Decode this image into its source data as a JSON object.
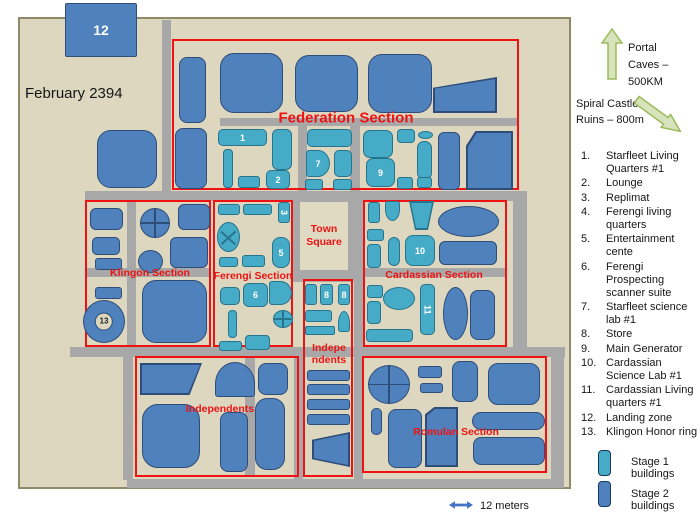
{
  "header": {
    "date": "February 2394"
  },
  "landmarks": {
    "portal": "Portal Caves – 500KM",
    "spiral": "Spiral Castle Ruins – 800m"
  },
  "key": {
    "items": [
      {
        "num": "1.",
        "label": "Starfleet Living Quarters #1"
      },
      {
        "num": "2.",
        "label": "Lounge"
      },
      {
        "num": "3.",
        "label": "Replimat"
      },
      {
        "num": "4.",
        "label": "Ferengi living quarters"
      },
      {
        "num": "5.",
        "label": "Entertainment cente"
      },
      {
        "num": "6.",
        "label": "Ferengi Prospecting scanner suite"
      },
      {
        "num": "7.",
        "label": "Starfleet science lab #1"
      },
      {
        "num": "8.",
        "label": "Store"
      },
      {
        "num": "9.",
        "label": "Main Generator"
      },
      {
        "num": "10.",
        "label": "Cardassian Science Lab #1"
      },
      {
        "num": "11.",
        "label": "Cardassian Living quarters #1"
      },
      {
        "num": "12.",
        "label": "Landing zone"
      },
      {
        "num": "13.",
        "label": "Klingon Honor ring"
      }
    ]
  },
  "legend": {
    "stage1": "Stage 1 buildings",
    "stage2": "Stage 2 buildings"
  },
  "scale": {
    "label": "12 meters"
  },
  "colors": {
    "map_bg": "#ddd7c0",
    "map_border": "#8f8968",
    "road": "#a8a8a8",
    "red": "#ee1212",
    "stage1_fill": "#46abc7",
    "stage1_border": "#26748e",
    "stage2_fill": "#4f81bd",
    "stage2_border": "#2e4d79",
    "square_bg": "#e0dac3",
    "arrow_fill": "#d6e3bc",
    "arrow_border": "#9bbb59",
    "scale_blue": "#4472c4",
    "text": "#161616"
  },
  "map": {
    "town_square": {
      "label": "Town Square",
      "x": 300,
      "y": 202,
      "w": 48,
      "h": 68
    },
    "sections": [
      {
        "id": "federation",
        "name": "Federation Section",
        "x": 172,
        "y": 39,
        "w": 347,
        "h": 151,
        "lx": 346,
        "ly": 118,
        "fs": 15
      },
      {
        "id": "klingon",
        "name": "Klingon Section",
        "x": 85,
        "y": 200,
        "w": 126,
        "h": 147,
        "lx": 150,
        "ly": 273,
        "fs": 10.5
      },
      {
        "id": "ferengi",
        "name": "Ferengi Section",
        "x": 213,
        "y": 200,
        "w": 80,
        "h": 147,
        "lx": 253,
        "ly": 276,
        "fs": 10.5
      },
      {
        "id": "cardassian",
        "name": "Cardassian Section",
        "x": 363,
        "y": 200,
        "w": 144,
        "h": 147,
        "lx": 434,
        "ly": 275,
        "fs": 10.5
      },
      {
        "id": "independents-mid",
        "name": "Indepe\nndents",
        "x": 303,
        "y": 279,
        "w": 50,
        "h": 198,
        "lx": 329,
        "ly": 354,
        "fs": 10.5
      },
      {
        "id": "independents",
        "name": "Independents",
        "x": 135,
        "y": 356,
        "w": 164,
        "h": 121,
        "lx": 220,
        "ly": 409,
        "fs": 10.5
      },
      {
        "id": "romulan",
        "name": "Romulan Section",
        "x": 362,
        "y": 356,
        "w": 185,
        "h": 117,
        "lx": 456,
        "ly": 432,
        "fs": 10.5
      }
    ],
    "roads": [
      [
        162,
        20,
        9,
        171
      ],
      [
        85,
        191,
        442,
        10
      ],
      [
        220,
        118,
        298,
        8
      ],
      [
        298,
        126,
        9,
        65
      ],
      [
        350,
        126,
        10,
        65
      ],
      [
        127,
        200,
        9,
        147
      ],
      [
        85,
        268,
        126,
        9
      ],
      [
        293,
        191,
        70,
        91
      ],
      [
        363,
        268,
        144,
        9
      ],
      [
        513,
        191,
        14,
        166
      ],
      [
        70,
        347,
        495,
        10
      ],
      [
        123,
        357,
        10,
        123
      ],
      [
        245,
        357,
        10,
        120
      ],
      [
        294,
        357,
        9,
        123
      ],
      [
        354,
        270,
        9,
        210
      ],
      [
        551,
        357,
        13,
        122
      ],
      [
        127,
        479,
        437,
        9
      ]
    ],
    "buildings": [
      {
        "x": 65,
        "y": 3,
        "w": 72,
        "h": 54,
        "s": 2,
        "sh": "r2",
        "lb": "12",
        "ls": 14
      },
      {
        "x": 97,
        "y": 130,
        "w": 60,
        "h": 58,
        "s": 2,
        "sh": "r14"
      },
      {
        "x": 179,
        "y": 57,
        "w": 27,
        "h": 66,
        "s": 2,
        "sh": "r8"
      },
      {
        "x": 220,
        "y": 53,
        "w": 63,
        "h": 60,
        "s": 2,
        "sh": "r14"
      },
      {
        "x": 295,
        "y": 55,
        "w": 63,
        "h": 57,
        "s": 2,
        "sh": "r14"
      },
      {
        "x": 368,
        "y": 54,
        "w": 64,
        "h": 59,
        "s": 2,
        "sh": "r14"
      },
      {
        "x": 433,
        "y": 77,
        "w": 64,
        "h": 36,
        "s": 2,
        "sh": "poly:0% 30%,100% 0%,100% 100%,0% 100%"
      },
      {
        "x": 175,
        "y": 128,
        "w": 32,
        "h": 61,
        "s": 2,
        "sh": "r8"
      },
      {
        "x": 218,
        "y": 129,
        "w": 49,
        "h": 17,
        "s": 1,
        "sh": "r5",
        "lb": "1"
      },
      {
        "x": 272,
        "y": 129,
        "w": 20,
        "h": 41,
        "s": 1,
        "sh": "r6"
      },
      {
        "x": 223,
        "y": 149,
        "w": 10,
        "h": 39,
        "s": 1,
        "sh": "r4"
      },
      {
        "x": 238,
        "y": 176,
        "w": 22,
        "h": 12,
        "s": 1,
        "sh": "r3"
      },
      {
        "x": 266,
        "y": 170,
        "w": 24,
        "h": 19,
        "s": 1,
        "sh": "r5",
        "lb": "2"
      },
      {
        "x": 307,
        "y": 129,
        "w": 45,
        "h": 18,
        "s": 1,
        "sh": "r5"
      },
      {
        "x": 306,
        "y": 150,
        "w": 24,
        "h": 27,
        "s": 1,
        "sh": "d-right",
        "lb": "7"
      },
      {
        "x": 334,
        "y": 150,
        "w": 18,
        "h": 27,
        "s": 1,
        "sh": "r5"
      },
      {
        "x": 305,
        "y": 179,
        "w": 18,
        "h": 11,
        "s": 1,
        "sh": "r3"
      },
      {
        "x": 333,
        "y": 179,
        "w": 19,
        "h": 11,
        "s": 1,
        "sh": "r3"
      },
      {
        "x": 363,
        "y": 130,
        "w": 30,
        "h": 28,
        "s": 1,
        "sh": "r7"
      },
      {
        "x": 366,
        "y": 158,
        "w": 29,
        "h": 29,
        "s": 1,
        "sh": "r7",
        "lb": "9"
      },
      {
        "x": 397,
        "y": 129,
        "w": 18,
        "h": 14,
        "s": 1,
        "sh": "r4"
      },
      {
        "x": 418,
        "y": 131,
        "w": 15,
        "h": 8,
        "s": 1,
        "sh": "ellipse"
      },
      {
        "x": 417,
        "y": 141,
        "w": 15,
        "h": 39,
        "s": 1,
        "sh": "r7"
      },
      {
        "x": 397,
        "y": 177,
        "w": 16,
        "h": 12,
        "s": 1,
        "sh": "r3"
      },
      {
        "x": 417,
        "y": 177,
        "w": 15,
        "h": 11,
        "s": 1,
        "sh": "r3"
      },
      {
        "x": 438,
        "y": 132,
        "w": 22,
        "h": 58,
        "s": 2,
        "sh": "r6"
      },
      {
        "x": 466,
        "y": 131,
        "w": 47,
        "h": 59,
        "s": 2,
        "sh": "poly:0% 25%,20% 0%,100% 0%,100% 100%,0% 100%"
      },
      {
        "x": 90,
        "y": 208,
        "w": 33,
        "h": 22,
        "s": 2,
        "sh": "r6"
      },
      {
        "x": 92,
        "y": 237,
        "w": 28,
        "h": 18,
        "s": 2,
        "sh": "r5"
      },
      {
        "x": 95,
        "y": 258,
        "w": 27,
        "h": 12,
        "s": 2,
        "sh": "r3"
      },
      {
        "x": 95,
        "y": 287,
        "w": 27,
        "h": 12,
        "s": 2,
        "sh": "r3"
      },
      {
        "x": 140,
        "y": 208,
        "w": 30,
        "h": 30,
        "s": 2,
        "sh": "circle-cross"
      },
      {
        "x": 178,
        "y": 204,
        "w": 32,
        "h": 26,
        "s": 2,
        "sh": "r6"
      },
      {
        "x": 138,
        "y": 250,
        "w": 25,
        "h": 23,
        "s": 2,
        "sh": "circle"
      },
      {
        "x": 170,
        "y": 237,
        "w": 38,
        "h": 31,
        "s": 2,
        "sh": "r6"
      },
      {
        "x": 83,
        "y": 300,
        "w": 42,
        "h": 43,
        "s": 2,
        "sh": "ring",
        "lb": "13"
      },
      {
        "x": 142,
        "y": 280,
        "w": 65,
        "h": 63,
        "s": 2,
        "sh": "r14"
      },
      {
        "x": 218,
        "y": 204,
        "w": 22,
        "h": 11,
        "s": 1,
        "sh": "r3"
      },
      {
        "x": 243,
        "y": 204,
        "w": 29,
        "h": 11,
        "s": 1,
        "sh": "r3"
      },
      {
        "x": 278,
        "y": 202,
        "w": 12,
        "h": 21,
        "s": 1,
        "sh": "r3",
        "lb": "3",
        "rot": 1
      },
      {
        "x": 217,
        "y": 222,
        "w": 23,
        "h": 30,
        "s": 1,
        "sh": "ellipse-x"
      },
      {
        "x": 272,
        "y": 237,
        "w": 18,
        "h": 31,
        "s": 1,
        "sh": "r8",
        "lb": "5"
      },
      {
        "x": 219,
        "y": 257,
        "w": 19,
        "h": 10,
        "s": 1,
        "sh": "r3"
      },
      {
        "x": 242,
        "y": 255,
        "w": 23,
        "h": 12,
        "s": 1,
        "sh": "r3"
      },
      {
        "x": 220,
        "y": 287,
        "w": 20,
        "h": 18,
        "s": 1,
        "sh": "r5"
      },
      {
        "x": 243,
        "y": 283,
        "w": 25,
        "h": 24,
        "s": 1,
        "sh": "r6",
        "lb": "6"
      },
      {
        "x": 269,
        "y": 281,
        "w": 23,
        "h": 24,
        "s": 1,
        "sh": "d-right"
      },
      {
        "x": 273,
        "y": 310,
        "w": 20,
        "h": 18,
        "s": 1,
        "sh": "circle-cross"
      },
      {
        "x": 228,
        "y": 310,
        "w": 9,
        "h": 28,
        "s": 1,
        "sh": "r4"
      },
      {
        "x": 219,
        "y": 341,
        "w": 23,
        "h": 10,
        "s": 1,
        "sh": "r3"
      },
      {
        "x": 245,
        "y": 335,
        "w": 25,
        "h": 15,
        "s": 1,
        "sh": "r4"
      },
      {
        "x": 368,
        "y": 202,
        "w": 12,
        "h": 21,
        "s": 1,
        "sh": "r3"
      },
      {
        "x": 385,
        "y": 201,
        "w": 15,
        "h": 20,
        "s": 1,
        "sh": "u-bottom"
      },
      {
        "x": 409,
        "y": 201,
        "w": 25,
        "h": 29,
        "s": 1,
        "sh": "poly:0% 0%,100% 0%,76% 100%,24% 100%"
      },
      {
        "x": 438,
        "y": 206,
        "w": 61,
        "h": 31,
        "s": 2,
        "sh": "ellipse"
      },
      {
        "x": 367,
        "y": 229,
        "w": 17,
        "h": 12,
        "s": 1,
        "sh": "r3"
      },
      {
        "x": 367,
        "y": 244,
        "w": 14,
        "h": 24,
        "s": 1,
        "sh": "r4"
      },
      {
        "x": 388,
        "y": 237,
        "w": 12,
        "h": 29,
        "s": 1,
        "sh": "r6"
      },
      {
        "x": 405,
        "y": 235,
        "w": 30,
        "h": 31,
        "s": 1,
        "sh": "r8",
        "lb": "10"
      },
      {
        "x": 439,
        "y": 241,
        "w": 58,
        "h": 24,
        "s": 2,
        "sh": "r6"
      },
      {
        "x": 367,
        "y": 285,
        "w": 16,
        "h": 13,
        "s": 1,
        "sh": "r3"
      },
      {
        "x": 367,
        "y": 301,
        "w": 14,
        "h": 23,
        "s": 1,
        "sh": "r4"
      },
      {
        "x": 383,
        "y": 287,
        "w": 32,
        "h": 23,
        "s": 1,
        "sh": "ellipse"
      },
      {
        "x": 420,
        "y": 284,
        "w": 15,
        "h": 51,
        "s": 1,
        "sh": "r5",
        "lb": "11",
        "rot": 1
      },
      {
        "x": 443,
        "y": 287,
        "w": 25,
        "h": 53,
        "s": 2,
        "sh": "ellipse"
      },
      {
        "x": 470,
        "y": 290,
        "w": 25,
        "h": 50,
        "s": 2,
        "sh": "r8"
      },
      {
        "x": 366,
        "y": 329,
        "w": 47,
        "h": 13,
        "s": 1,
        "sh": "r4"
      },
      {
        "x": 305,
        "y": 284,
        "w": 12,
        "h": 21,
        "s": 1,
        "sh": "r3"
      },
      {
        "x": 320,
        "y": 284,
        "w": 13,
        "h": 21,
        "s": 1,
        "sh": "r3",
        "lb": "8"
      },
      {
        "x": 338,
        "y": 284,
        "w": 12,
        "h": 21,
        "s": 1,
        "sh": "r3",
        "lb": "8"
      },
      {
        "x": 305,
        "y": 310,
        "w": 27,
        "h": 12,
        "s": 1,
        "sh": "r3"
      },
      {
        "x": 338,
        "y": 311,
        "w": 12,
        "h": 21,
        "s": 1,
        "sh": "arch"
      },
      {
        "x": 305,
        "y": 326,
        "w": 30,
        "h": 9,
        "s": 1,
        "sh": "r2"
      },
      {
        "x": 307,
        "y": 370,
        "w": 43,
        "h": 11,
        "s": 2,
        "sh": "r3"
      },
      {
        "x": 307,
        "y": 384,
        "w": 43,
        "h": 11,
        "s": 2,
        "sh": "r3"
      },
      {
        "x": 307,
        "y": 399,
        "w": 43,
        "h": 11,
        "s": 2,
        "sh": "r3"
      },
      {
        "x": 307,
        "y": 414,
        "w": 43,
        "h": 11,
        "s": 2,
        "sh": "r3"
      },
      {
        "x": 312,
        "y": 432,
        "w": 38,
        "h": 35,
        "s": 2,
        "sh": "poly:100% 0%,100% 100%,0% 78%,0% 22%"
      },
      {
        "x": 140,
        "y": 363,
        "w": 62,
        "h": 32,
        "s": 2,
        "sh": "poly:0% 0%,100% 0%,80% 100%,0% 100%"
      },
      {
        "x": 142,
        "y": 404,
        "w": 58,
        "h": 64,
        "s": 2,
        "sh": "r16"
      },
      {
        "x": 215,
        "y": 362,
        "w": 40,
        "h": 35,
        "s": 2,
        "sh": "arch"
      },
      {
        "x": 258,
        "y": 363,
        "w": 30,
        "h": 32,
        "s": 2,
        "sh": "r8"
      },
      {
        "x": 220,
        "y": 412,
        "w": 28,
        "h": 60,
        "s": 2,
        "sh": "r8"
      },
      {
        "x": 255,
        "y": 398,
        "w": 30,
        "h": 72,
        "s": 2,
        "sh": "r12"
      },
      {
        "x": 368,
        "y": 365,
        "w": 42,
        "h": 39,
        "s": 2,
        "sh": "circle-cross"
      },
      {
        "x": 418,
        "y": 366,
        "w": 24,
        "h": 12,
        "s": 2,
        "sh": "r3"
      },
      {
        "x": 420,
        "y": 383,
        "w": 23,
        "h": 10,
        "s": 2,
        "sh": "r3"
      },
      {
        "x": 452,
        "y": 361,
        "w": 26,
        "h": 41,
        "s": 2,
        "sh": "r8"
      },
      {
        "x": 488,
        "y": 363,
        "w": 52,
        "h": 42,
        "s": 2,
        "sh": "r10"
      },
      {
        "x": 371,
        "y": 408,
        "w": 11,
        "h": 27,
        "s": 2,
        "sh": "r5"
      },
      {
        "x": 388,
        "y": 409,
        "w": 34,
        "h": 59,
        "s": 2,
        "sh": "r8"
      },
      {
        "x": 425,
        "y": 407,
        "w": 33,
        "h": 60,
        "s": 2,
        "sh": "poly:0% 12%,28% 0%,100% 0%,100% 100%,0% 100%"
      },
      {
        "x": 472,
        "y": 412,
        "w": 73,
        "h": 18,
        "s": 2,
        "sh": "r9"
      },
      {
        "x": 473,
        "y": 437,
        "w": 72,
        "h": 28,
        "s": 2,
        "sh": "r8"
      }
    ]
  }
}
